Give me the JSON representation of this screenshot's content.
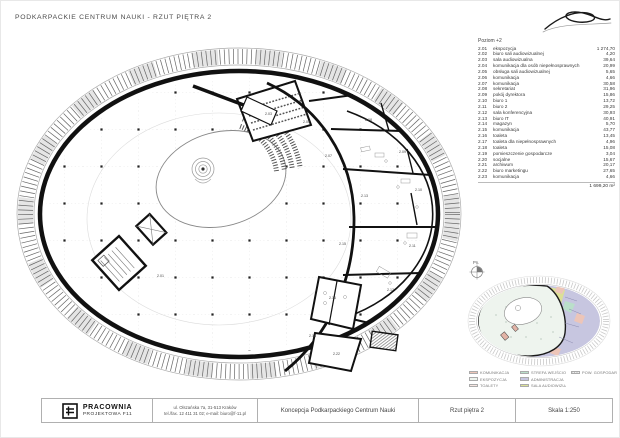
{
  "page": {
    "title": "PODKARPACKIE CENTRUM NAUKI  - RZUT PIĘTRA 2"
  },
  "schedule": {
    "header": "Poziom +2",
    "rows": [
      {
        "no": "2.01",
        "name": "ekspozycja",
        "area": "1 274,70"
      },
      {
        "no": "2.02",
        "name": "biuro sali audiowizualnej",
        "area": "4,20"
      },
      {
        "no": "2.03",
        "name": "sala audiowizualna",
        "area": "39,64"
      },
      {
        "no": "2.04",
        "name": "komunikacja dla osób niepełnosprawnych",
        "area": "20,99"
      },
      {
        "no": "2.05",
        "name": "obsługa sali audiowizualnej",
        "area": "5,65"
      },
      {
        "no": "2.06",
        "name": "komunikacja",
        "area": "4,66"
      },
      {
        "no": "2.07",
        "name": "komunikacja",
        "area": "30,58"
      },
      {
        "no": "2.08",
        "name": "sekretariat",
        "area": "31,96"
      },
      {
        "no": "2.09",
        "name": "pokój dyrektora",
        "area": "15,86"
      },
      {
        "no": "2.10",
        "name": "biuro 1",
        "area": "13,72"
      },
      {
        "no": "2.11",
        "name": "biuro 2",
        "area": "29,25"
      },
      {
        "no": "2.12",
        "name": "sala konferencyjna",
        "area": "30,93"
      },
      {
        "no": "2.13",
        "name": "biuro IT",
        "area": "40,91"
      },
      {
        "no": "2.14",
        "name": "magazyn",
        "area": "5,70"
      },
      {
        "no": "2.15",
        "name": "komunikacja",
        "area": "43,77"
      },
      {
        "no": "2.16",
        "name": "toaleta",
        "area": "13,45"
      },
      {
        "no": "2.17",
        "name": "toaleta dla niepełnosprawnych",
        "area": "4,96"
      },
      {
        "no": "2.18",
        "name": "toaleta",
        "area": "15,08"
      },
      {
        "no": "2.19",
        "name": "pomieszczenie gospodarcze",
        "area": "3,04"
      },
      {
        "no": "2.20",
        "name": "socjalne",
        "area": "15,67"
      },
      {
        "no": "2.21",
        "name": "archiwum",
        "area": "20,17"
      },
      {
        "no": "2.22",
        "name": "biuro marketingu",
        "area": "27,65"
      },
      {
        "no": "2.23",
        "name": "komunikacja",
        "area": "4,66"
      }
    ],
    "total": "1 699,20 m²"
  },
  "plan": {
    "labels": [
      "2.01",
      "2.03",
      "2.05",
      "2.07",
      "2.08",
      "2.09",
      "2.10",
      "2.11",
      "2.12",
      "2.13",
      "2.15",
      "2.16",
      "2.18",
      "2.22"
    ]
  },
  "minimap": {
    "north_label": "Pn.",
    "legend": [
      {
        "label": "KOMUNIKACJA",
        "color": "#edc5b8",
        "type": "fill"
      },
      {
        "label": "EKSPOZYCJA",
        "color": "#eef4ee",
        "type": "fill"
      },
      {
        "label": "TOALETY",
        "color": "#f7e6e2",
        "type": "fill"
      },
      {
        "label": "STREFA WEJŚCIOWA",
        "color": "#badfca",
        "type": "fill"
      },
      {
        "label": "ADMINISTRACJA",
        "color": "#c7c6e0",
        "type": "fill"
      },
      {
        "label": "SALA AUDIOWIZUALNA",
        "color": "#dce096",
        "type": "fill"
      },
      {
        "label": "POW. GOSPODARCZA",
        "color": "#d9d9d9",
        "type": "hatch"
      }
    ]
  },
  "titleblock": {
    "company_name": "PRACOWNIA",
    "company_sub": "PROJEKTOWA F11",
    "address_line1": "ul. Olszańska 7a, 31-513 Kraków",
    "address_line2": "tel./fax. 12 411 31 02; e-mail: biuro@f-11.pl",
    "project": "Koncepcja Podkarpackiego Centrum Nauki",
    "drawing": "Rzut piętra 2",
    "scale": "Skala 1:250"
  }
}
